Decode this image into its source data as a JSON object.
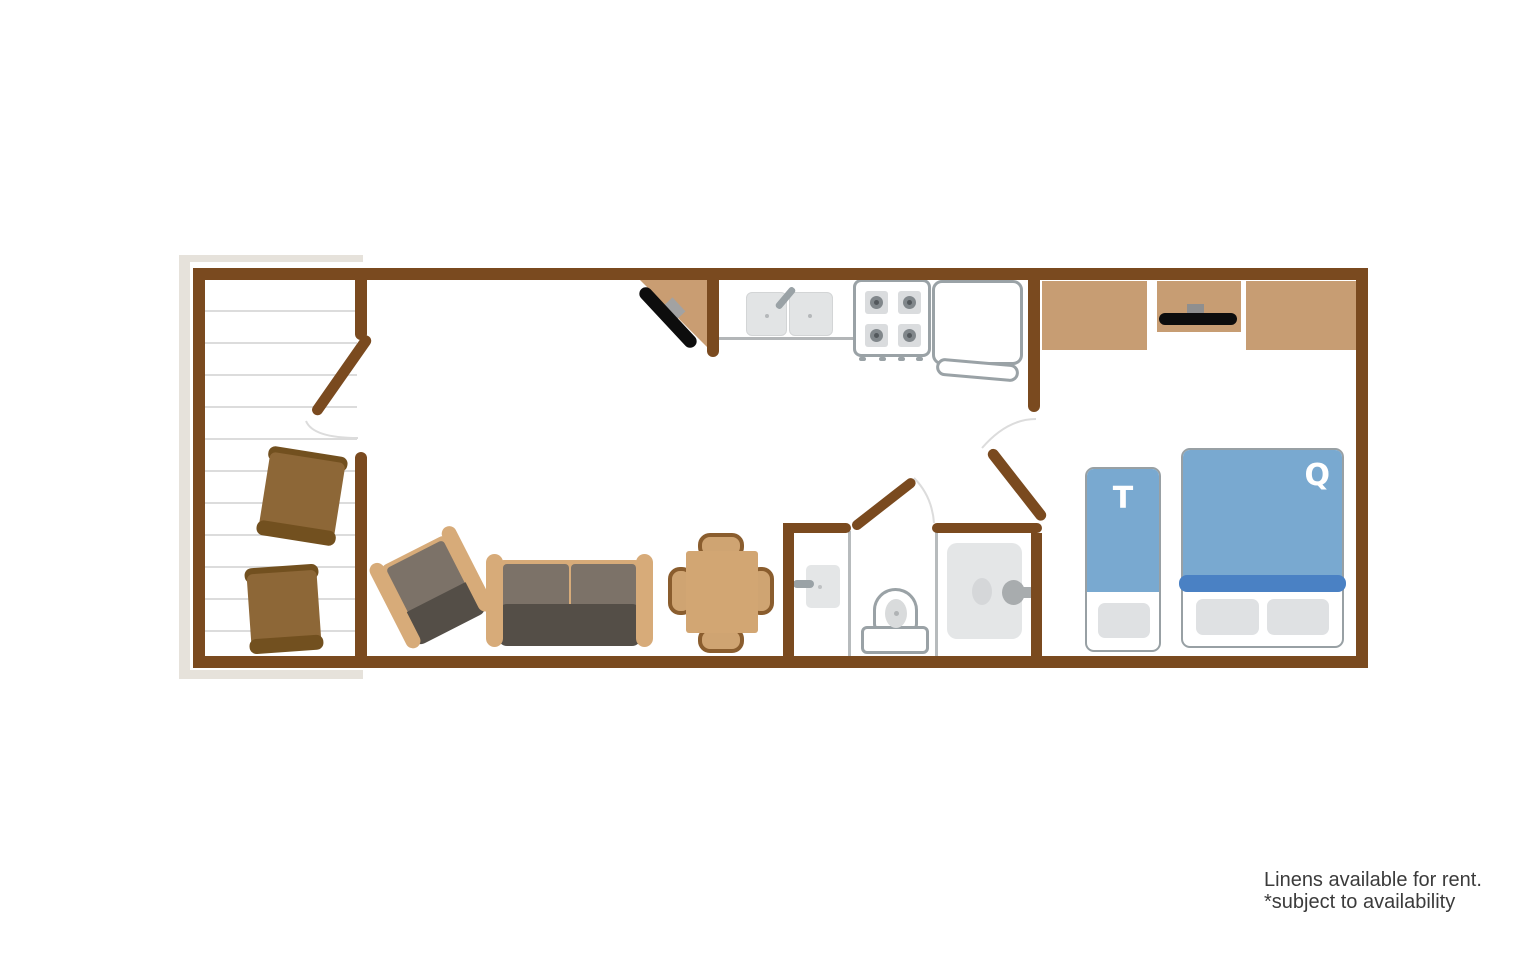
{
  "floorplan": {
    "bed_labels": {
      "twin": "T",
      "queen": "Q"
    },
    "note": {
      "line1": "Linens available for rent.",
      "line2": "*subject to availability"
    },
    "colors": {
      "wall_brown": "#7a4a1f",
      "cabinet_tan": "#c79d73",
      "sofa_wood_tan": "#d7ab79",
      "deck_chair_brown": "#8d6737",
      "deck_chair_dark": "#72501f",
      "cushion_gray": "#7c7268",
      "cushion_dark": "#544e47",
      "bed_blue": "#79a9d0",
      "bed_blue_dark": "#4a81c4",
      "fixture_outline_gray": "#9aa2a6",
      "fixture_fill_gray": "#e4e6e7",
      "pillow_gray": "#dfe1e3",
      "tv_black": "#0d0d0d",
      "deck_frame_gray": "#e6e2db",
      "deck_board_line": "#dcdcdc",
      "note_text": "#3b3b3b"
    },
    "furniture_icons": [
      "deck-chair",
      "armchair",
      "sofa",
      "dining-table",
      "dining-chair",
      "corner-tv",
      "kitchen-sink",
      "faucet",
      "stove",
      "refrigerator",
      "wall-tv",
      "dresser",
      "bathroom-sink",
      "toilet",
      "shower",
      "twin-bed",
      "queen-bed",
      "door",
      "door-swing-arc"
    ]
  }
}
